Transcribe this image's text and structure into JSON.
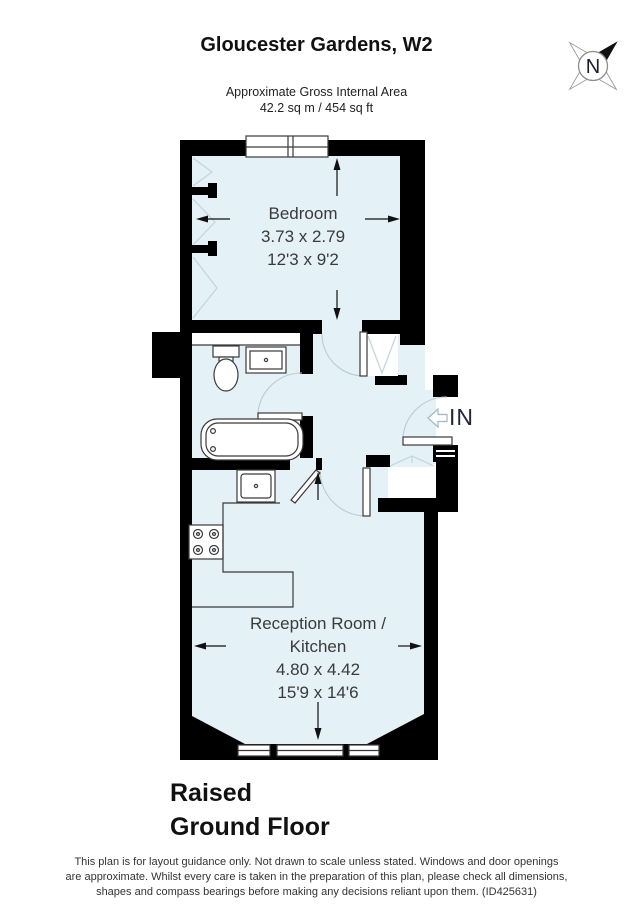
{
  "header": {
    "title": "Gloucester Gardens, W2",
    "area_line1": "Approximate Gross Internal Area",
    "area_line2": "42.2 sq m / 454 sq ft"
  },
  "compass": {
    "label": "N"
  },
  "plan": {
    "bedroom": {
      "name": "Bedroom",
      "metric": "3.73 x 2.79",
      "imperial": "12'3 x 9'2"
    },
    "reception": {
      "name_line1": "Reception Room /",
      "name_line2": "Kitchen",
      "metric": "4.80 x 4.42",
      "imperial": "15'9 x 14'6"
    },
    "entrance_label": "IN"
  },
  "floor": {
    "line1": "Raised",
    "line2": "Ground Floor"
  },
  "disclaimer": {
    "line1": "This plan is for layout guidance only. Not drawn to scale unless stated. Windows and door openings",
    "line2": "are approximate. Whilst every care is taken in the preparation of this plan, please check all dimensions,",
    "line3": "shapes and compass bearings before making any decisions reliant upon them. (ID425631)"
  },
  "colors": {
    "room_fill": "#e4f1f7",
    "wall": "#000000",
    "door_arc": "#b7cdd6",
    "closet_line": "#c3d4dc",
    "label": "#3a3a3a"
  }
}
